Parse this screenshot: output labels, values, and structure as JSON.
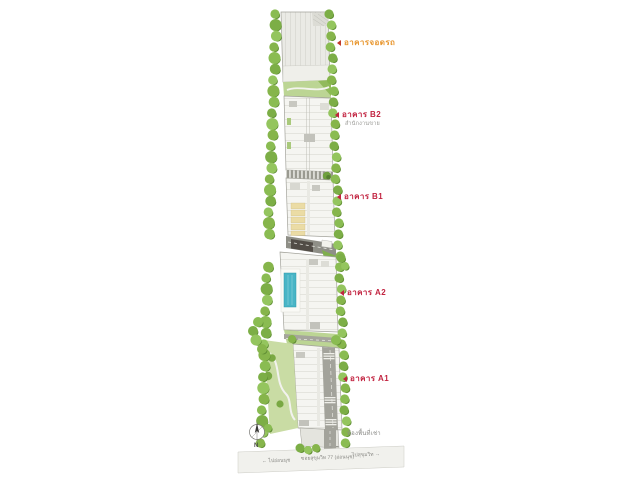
{
  "site": {
    "labels": [
      {
        "id": "parking",
        "text": "อาคารจอดรถ",
        "color": "#E8962E",
        "marker": "#C0392B"
      },
      {
        "id": "b2",
        "text": "อาคาร  B2",
        "subtitle": "สำนักงานขาย",
        "color": "#C22340"
      },
      {
        "id": "b1",
        "text": "อาคาร  B1",
        "color": "#C22340"
      },
      {
        "id": "a2",
        "text": "อาคาร  A2",
        "color": "#C22340"
      },
      {
        "id": "a1",
        "text": "อาคาร  A1",
        "color": "#C22340"
      }
    ],
    "notes": {
      "rental": "ห้องพื้นที่เช่า"
    },
    "road": {
      "left": "← ไปอ่อนนุช",
      "name": "ซอยสุขุมวิท 77 (อ่อนนุช)",
      "right": "ไปสุขุมวิท →"
    },
    "compass": {
      "label": "N"
    },
    "colors": {
      "label_red": "#C22340",
      "label_orange": "#E8962E",
      "tree_green": "#86B54B",
      "pool_blue": "#49B5C6"
    }
  }
}
